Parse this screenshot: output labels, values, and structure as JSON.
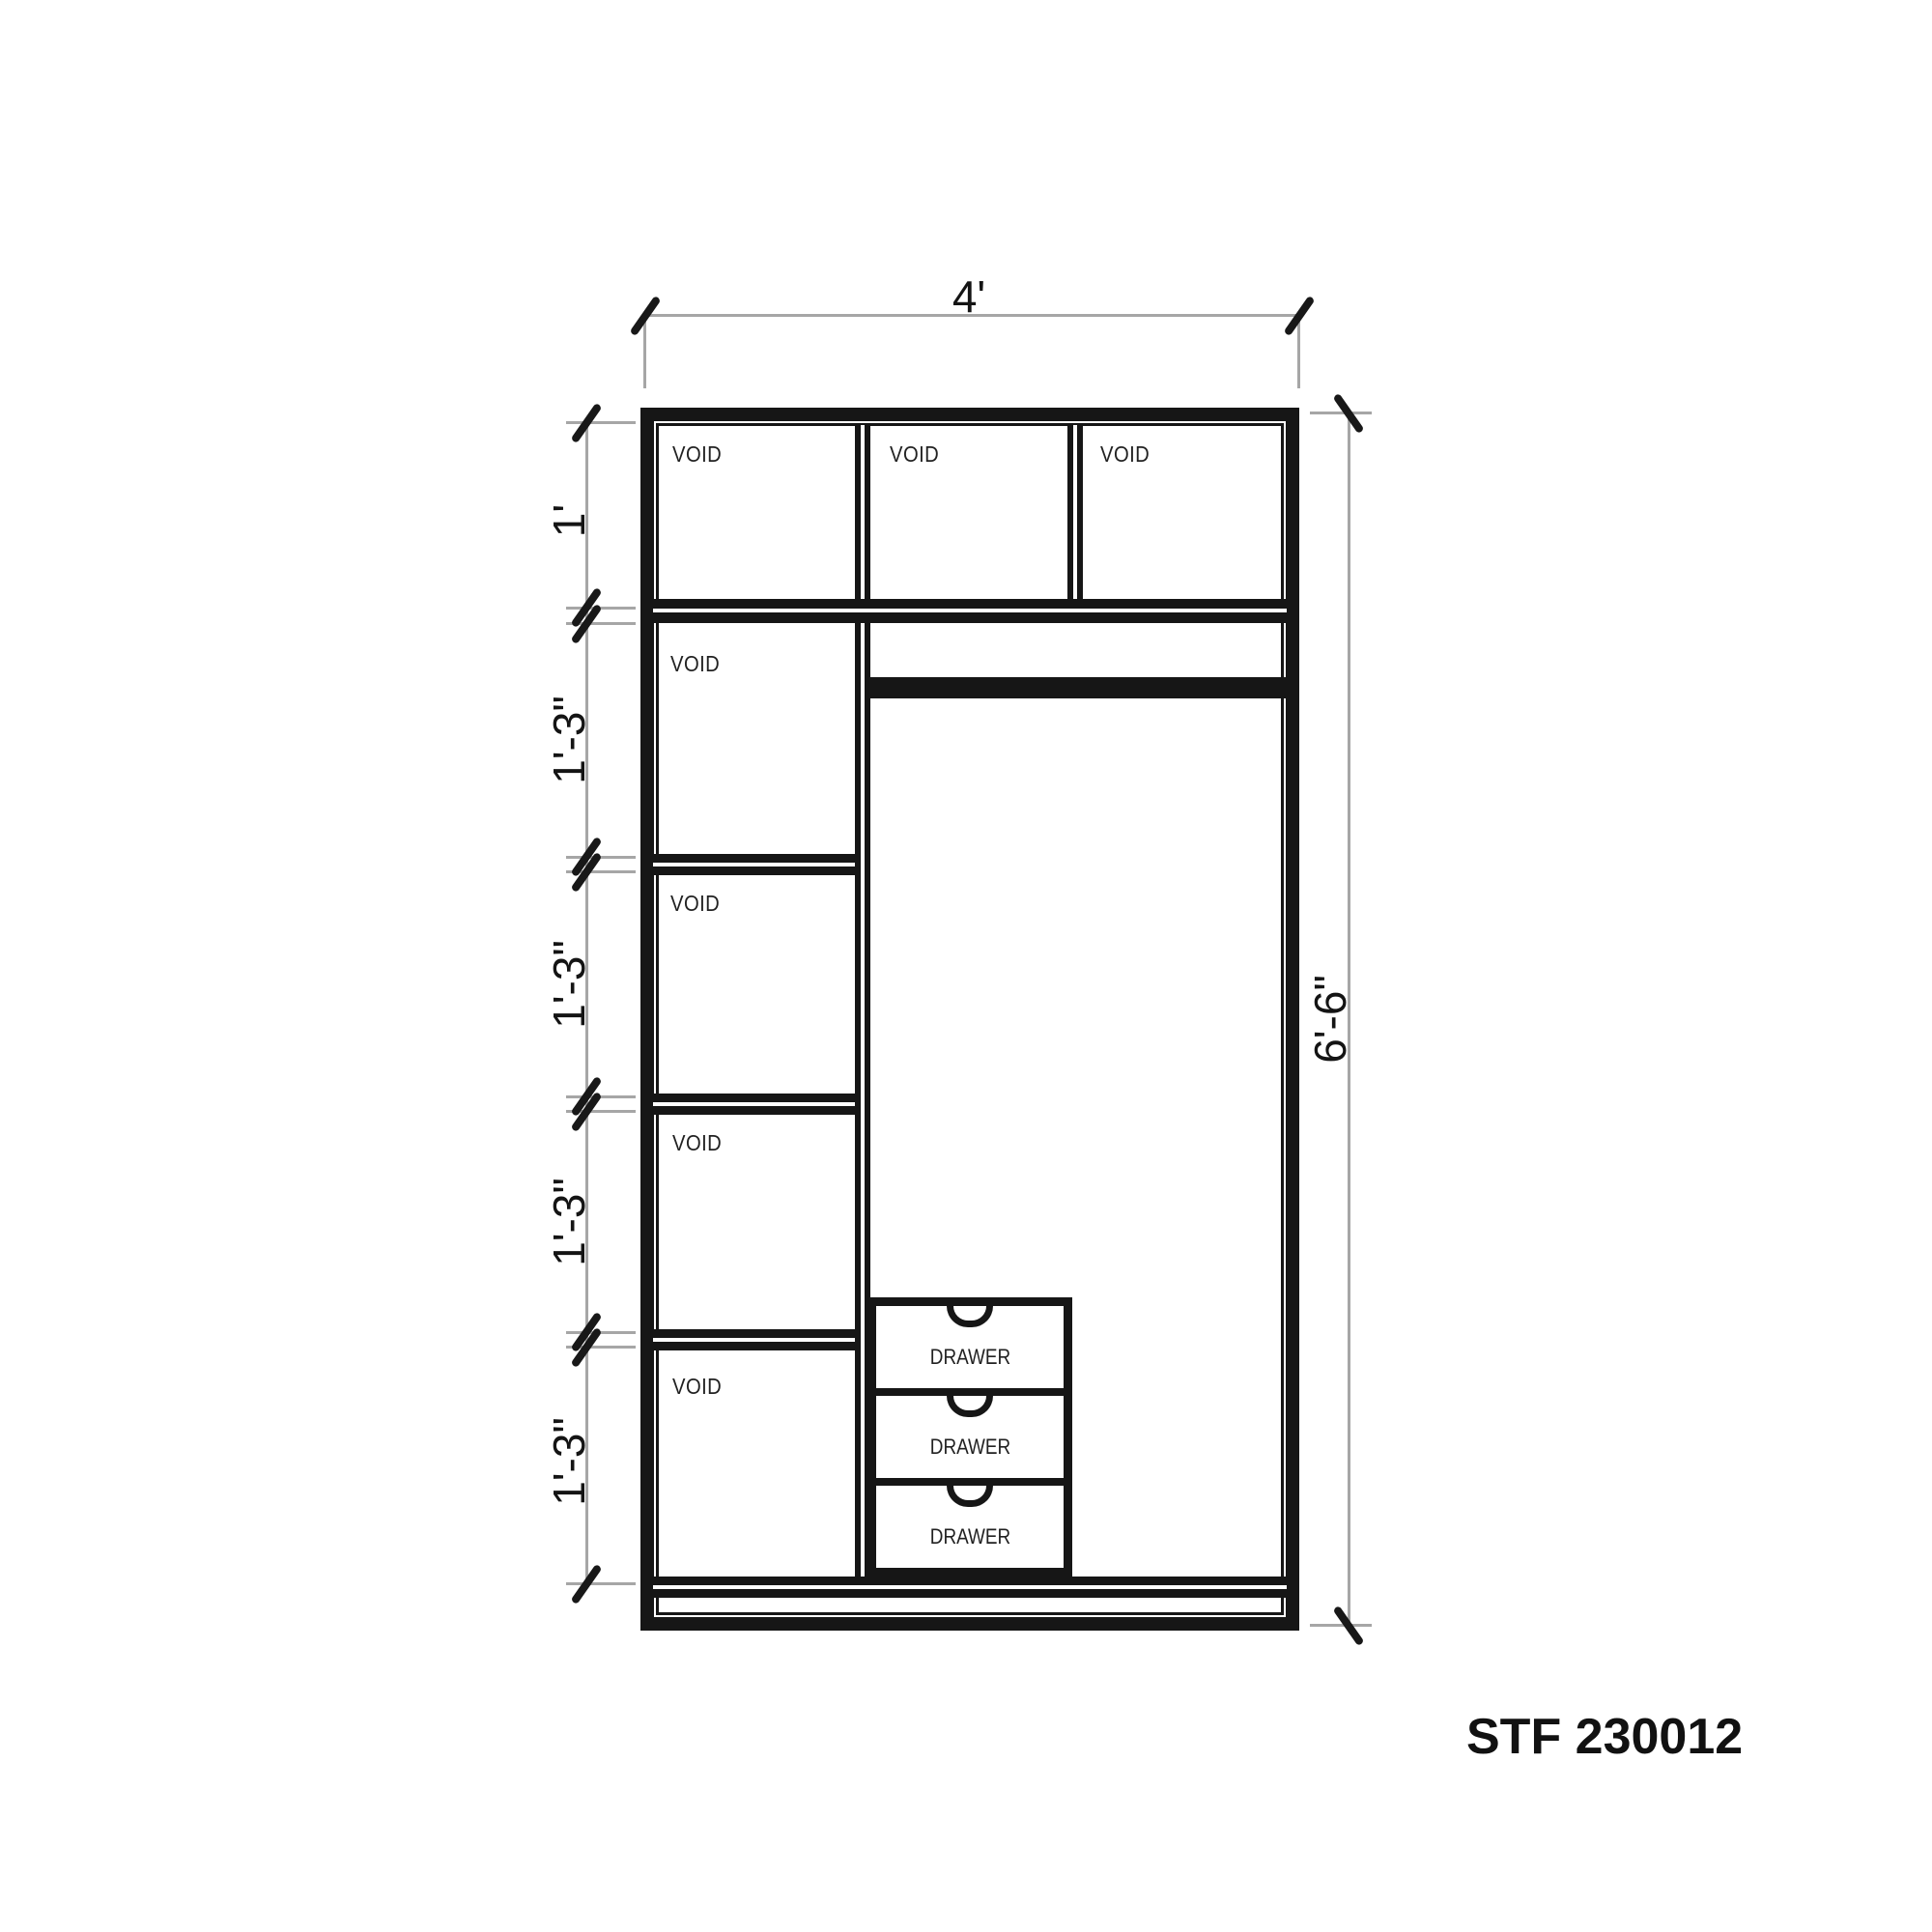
{
  "drawing": {
    "type": "wardrobe-elevation",
    "code": "STF 230012",
    "labels": {
      "void": "VOID",
      "drawer": "DRAWER"
    },
    "dims": {
      "top_width": "4'",
      "right_height": "6'-6\"",
      "left_segments": [
        "1'",
        "1'-3\"",
        "1'-3\"",
        "1'-3\"",
        "1'-3\""
      ]
    },
    "counts": {
      "void_compartments": 7,
      "drawers": 3
    },
    "colors": {
      "line": "#161616",
      "dimension_line": "#a6a6a6",
      "background": "#ffffff"
    }
  }
}
